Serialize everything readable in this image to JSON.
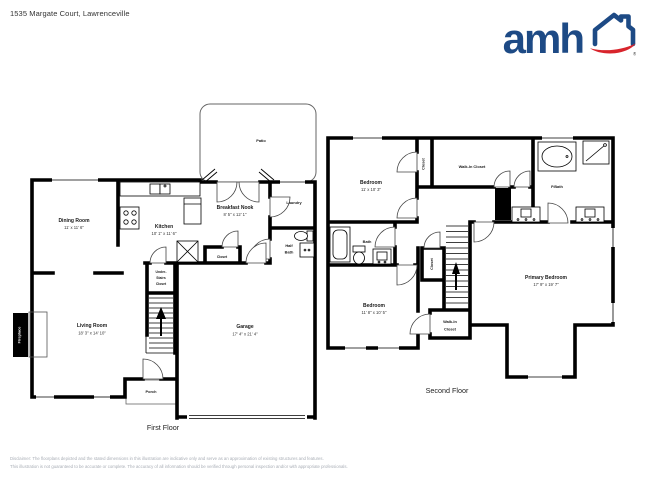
{
  "header": {
    "address": "1535 Margate Court, Lawrenceville",
    "logo": {
      "text": "amh",
      "registered": "®",
      "brand_blue": "#1d4a85",
      "brand_red": "#d8242c"
    }
  },
  "colors": {
    "walls": "#000000",
    "background": "#ffffff",
    "disclaimer_text": "#a9aeb6"
  },
  "first_floor": {
    "label": "First Floor",
    "patio": "Patio",
    "dining": {
      "name": "Dining Room",
      "dims": "11' x 11' 6\""
    },
    "kitchen": {
      "name": "Kitchen",
      "dims": "10' 1\" x 11' 6\""
    },
    "breakfast": {
      "name": "Breakfast Nook",
      "dims": "8' 5\" x 12' 1\""
    },
    "laundry": "Laundry",
    "half_bath": {
      "lines": [
        "Half",
        "Bath"
      ]
    },
    "closet": "Closet",
    "under_stairs": {
      "lines": [
        "Under-",
        "Stairs",
        "Closet"
      ]
    },
    "living": {
      "name": "Living Room",
      "dims": "18' 3\" x 14' 10\""
    },
    "garage": {
      "name": "Garage",
      "dims": "17' 4\" x 21' 4\""
    },
    "porch": "Porch",
    "fireplace": "Fireplace"
  },
  "second_floor": {
    "label": "Second Floor",
    "bedroom1": {
      "name": "Bedroom",
      "dims": "11' x 10' 3\""
    },
    "closet_top": "Closet",
    "walk_in_closet_top": "Walk-In Closet",
    "pbath": "P.Bath",
    "bath": "Bath",
    "closet_mid": "Closet",
    "bedroom2": {
      "name": "Bedroom",
      "dims": "11' 8\" x 10' 5\""
    },
    "walk_in_closet_bottom": {
      "lines": [
        "Walk-In",
        "Closet"
      ]
    },
    "primary": {
      "name": "Primary Bedroom",
      "dims": "17' 9\" x 19' 7\""
    }
  },
  "footer": {
    "line1": "Disclaimer: The floorplans depicted and the stated dimensions in this illustration are indicative only and serve as an approximation of existing structures and features.",
    "line2": "This illustration is not guaranteed to be accurate or complete. The accuracy of all information should be verified through personal inspection and/or with appropriate professionals."
  }
}
